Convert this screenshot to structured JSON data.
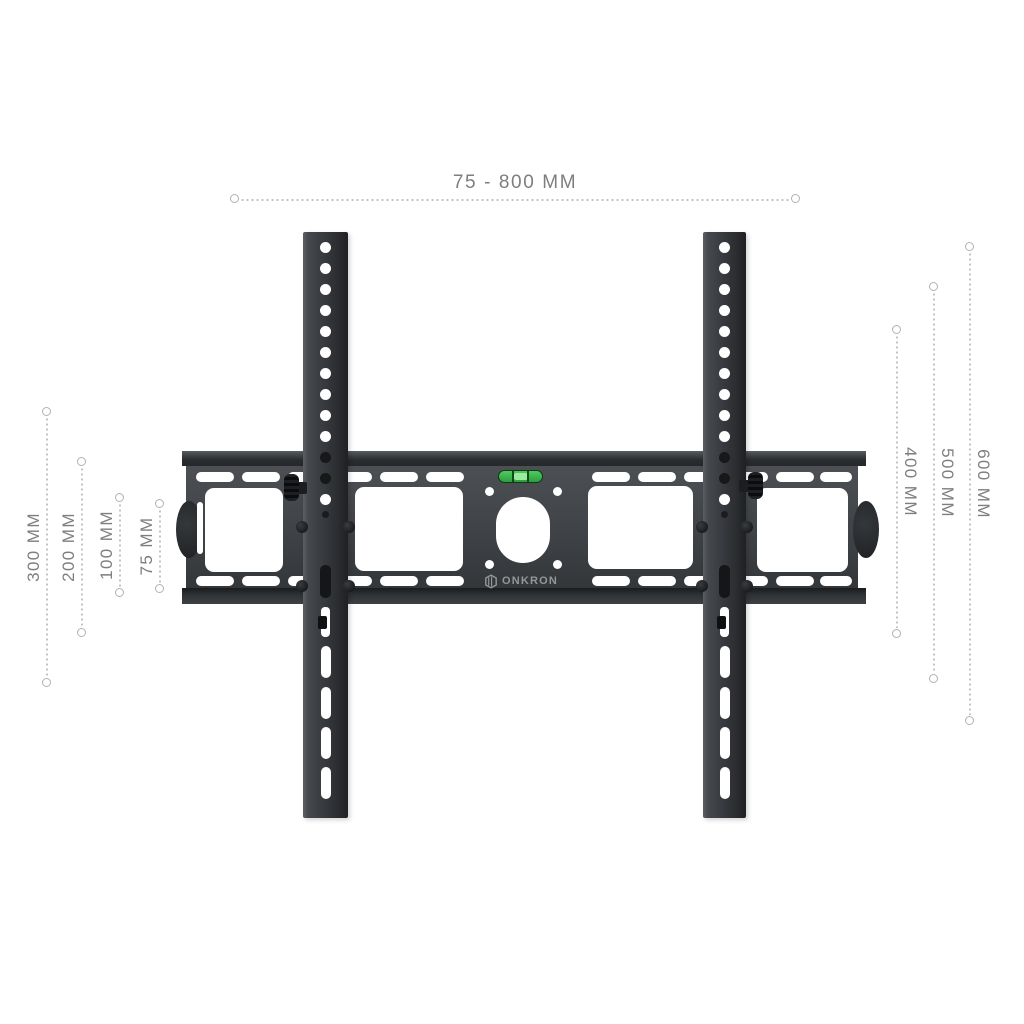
{
  "product": {
    "brand_label": "ONKRON",
    "description": "Tilting TV wall mount bracket shown front-on with wall plate and two VESA rails"
  },
  "dimensions": {
    "top": {
      "label": "75 - 800 MM"
    },
    "left": [
      {
        "label": "300 MM"
      },
      {
        "label": "200 MM"
      },
      {
        "label": "100 MM"
      },
      {
        "label": "75 MM"
      }
    ],
    "right": [
      {
        "label": "400 MM"
      },
      {
        "label": "500 MM"
      },
      {
        "label": "600 MM"
      }
    ]
  },
  "colors": {
    "background": "#ffffff",
    "dimension_text": "#7e7e7e",
    "dotted_line": "#c2c2c2",
    "metal_face": "#45484b",
    "metal_dark": "#2c2f32",
    "rail_dark": "#33363a",
    "cutout_white": "#ffffff",
    "level_green": "#3fbf4f",
    "level_bubble": "#9bea9e",
    "logo_text": "#94979a"
  },
  "icons": [
    {
      "name": "onkron-cube-icon",
      "meaning": "ONKRON brand cube logo"
    },
    {
      "name": "bubble-level",
      "meaning": "built-in spirit level indicator"
    }
  ]
}
